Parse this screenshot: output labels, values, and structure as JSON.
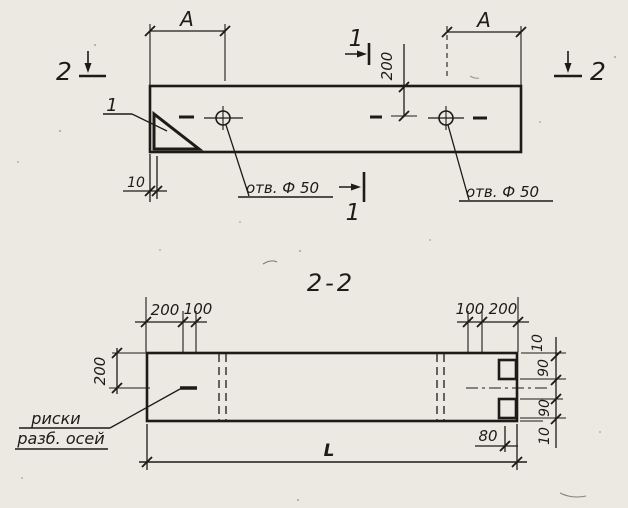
{
  "meta": {
    "paper_color": "#ebe9e2",
    "ink_color": "#1d1b18",
    "drawing_type": "panel shop drawing, plan and section"
  },
  "plan": {
    "dim_a_left": "А",
    "dim_a_right": "А",
    "dim_200": "200",
    "dim_10": "10",
    "hole_left_label": "отв. Ф 50",
    "hole_right_label": "отв. Ф 50",
    "detail_mark": "1",
    "section1_top": "1",
    "section1_bottom": "1",
    "section2_left": "2",
    "section2_right": "2"
  },
  "section": {
    "title": "2-2",
    "top_left_dims": [
      "200",
      "100"
    ],
    "top_right_dims": [
      "100",
      "200"
    ],
    "height_dim": "200",
    "right_dims": [
      "10",
      "90",
      "90",
      "10"
    ],
    "end_dim": "80",
    "length_dim": "L",
    "note_line1": "риски",
    "note_line2": "разб. осей"
  }
}
